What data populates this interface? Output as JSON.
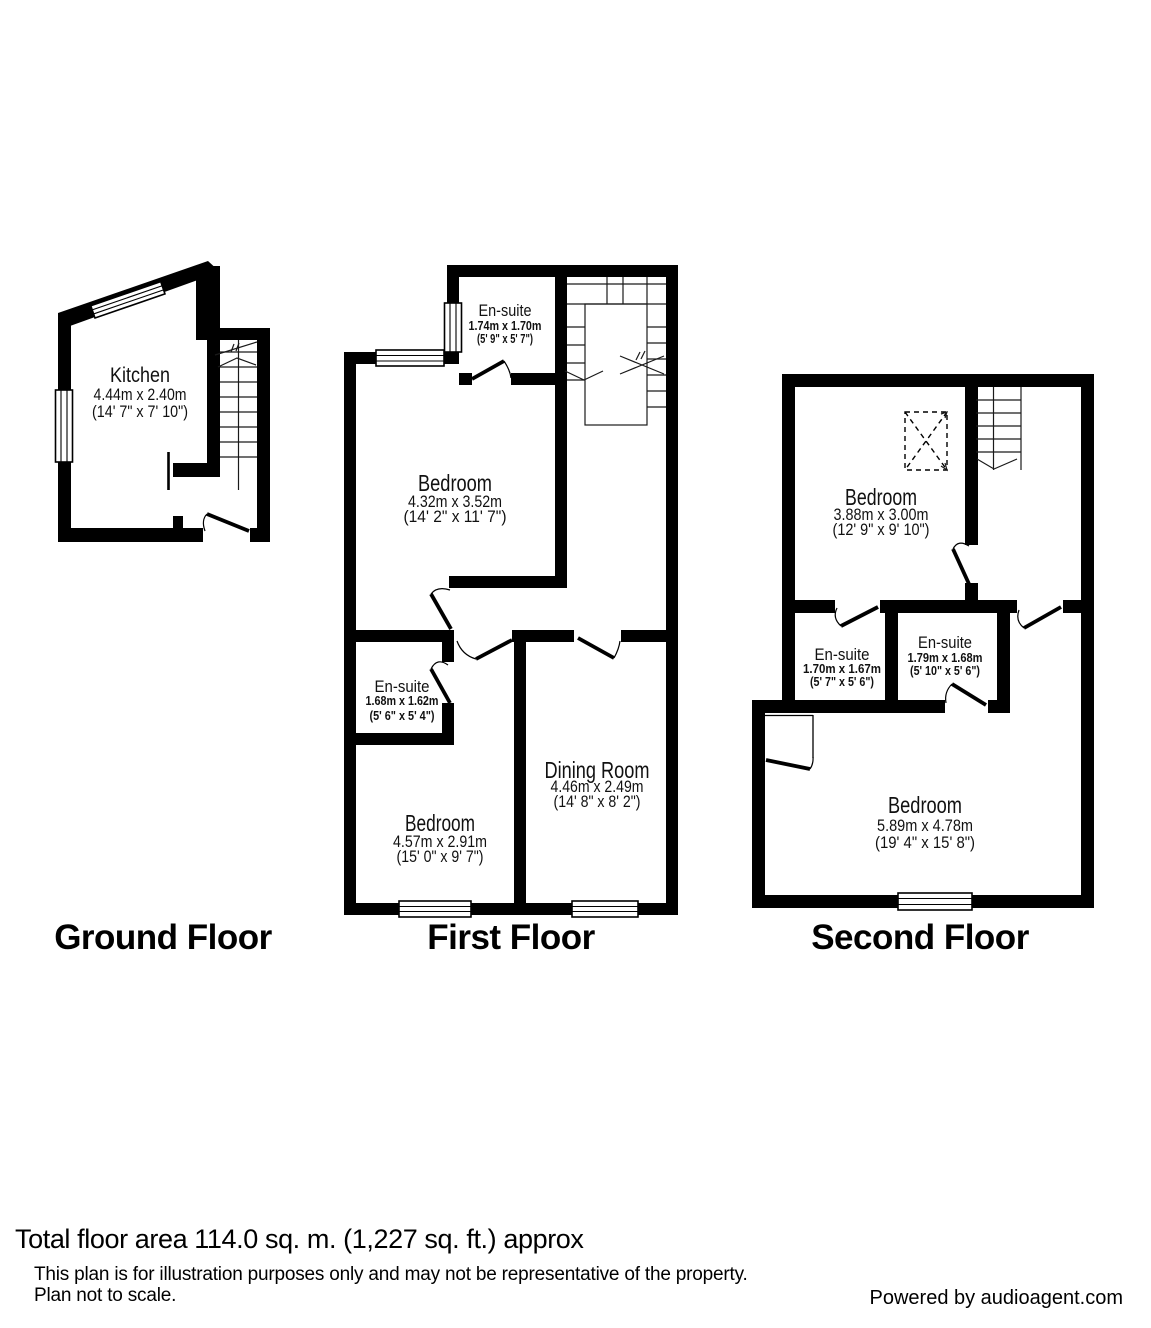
{
  "floors": [
    {
      "label": "Ground Floor",
      "rooms": [
        {
          "name": "Kitchen",
          "metric": "4.44m x 2.40m",
          "imperial": "(14' 7\" x 7' 10\")"
        }
      ]
    },
    {
      "label": "First Floor",
      "rooms": [
        {
          "name": "En-suite",
          "metric": "1.74m x 1.70m",
          "imperial": "(5' 9\" x 5' 7\")"
        },
        {
          "name": "Bedroom",
          "metric": "4.32m x 3.52m",
          "imperial": "(14' 2\" x 11' 7\")"
        },
        {
          "name": "En-suite",
          "metric": "1.68m x 1.62m",
          "imperial": "(5' 6\" x 5' 4\")"
        },
        {
          "name": "Bedroom",
          "metric": "4.57m x 2.91m",
          "imperial": "(15' 0\" x 9' 7\")"
        },
        {
          "name": "Dining Room",
          "metric": "4.46m x 2.49m",
          "imperial": "(14' 8\" x 8' 2\")"
        }
      ]
    },
    {
      "label": "Second Floor",
      "rooms": [
        {
          "name": "Bedroom",
          "metric": "3.88m x 3.00m",
          "imperial": "(12' 9\" x 9' 10\")"
        },
        {
          "name": "En-suite",
          "metric": "1.70m x 1.67m",
          "imperial": "(5' 7\" x 5' 6\")"
        },
        {
          "name": "En-suite",
          "metric": "1.79m x 1.68m",
          "imperial": "(5' 10\" x 5' 6\")"
        },
        {
          "name": "Bedroom",
          "metric": "5.89m x 4.78m",
          "imperial": "(19' 4\" x 15' 8\")"
        }
      ]
    }
  ],
  "footer": {
    "total_area": "Total floor area 114.0 sq. m. (1,227 sq. ft.) approx",
    "disclaimer_line1": "This plan is for illustration purposes only and may not be representative of the property.",
    "disclaimer_line2": "Plan not to scale.",
    "credit": "Powered by audioagent.com"
  }
}
